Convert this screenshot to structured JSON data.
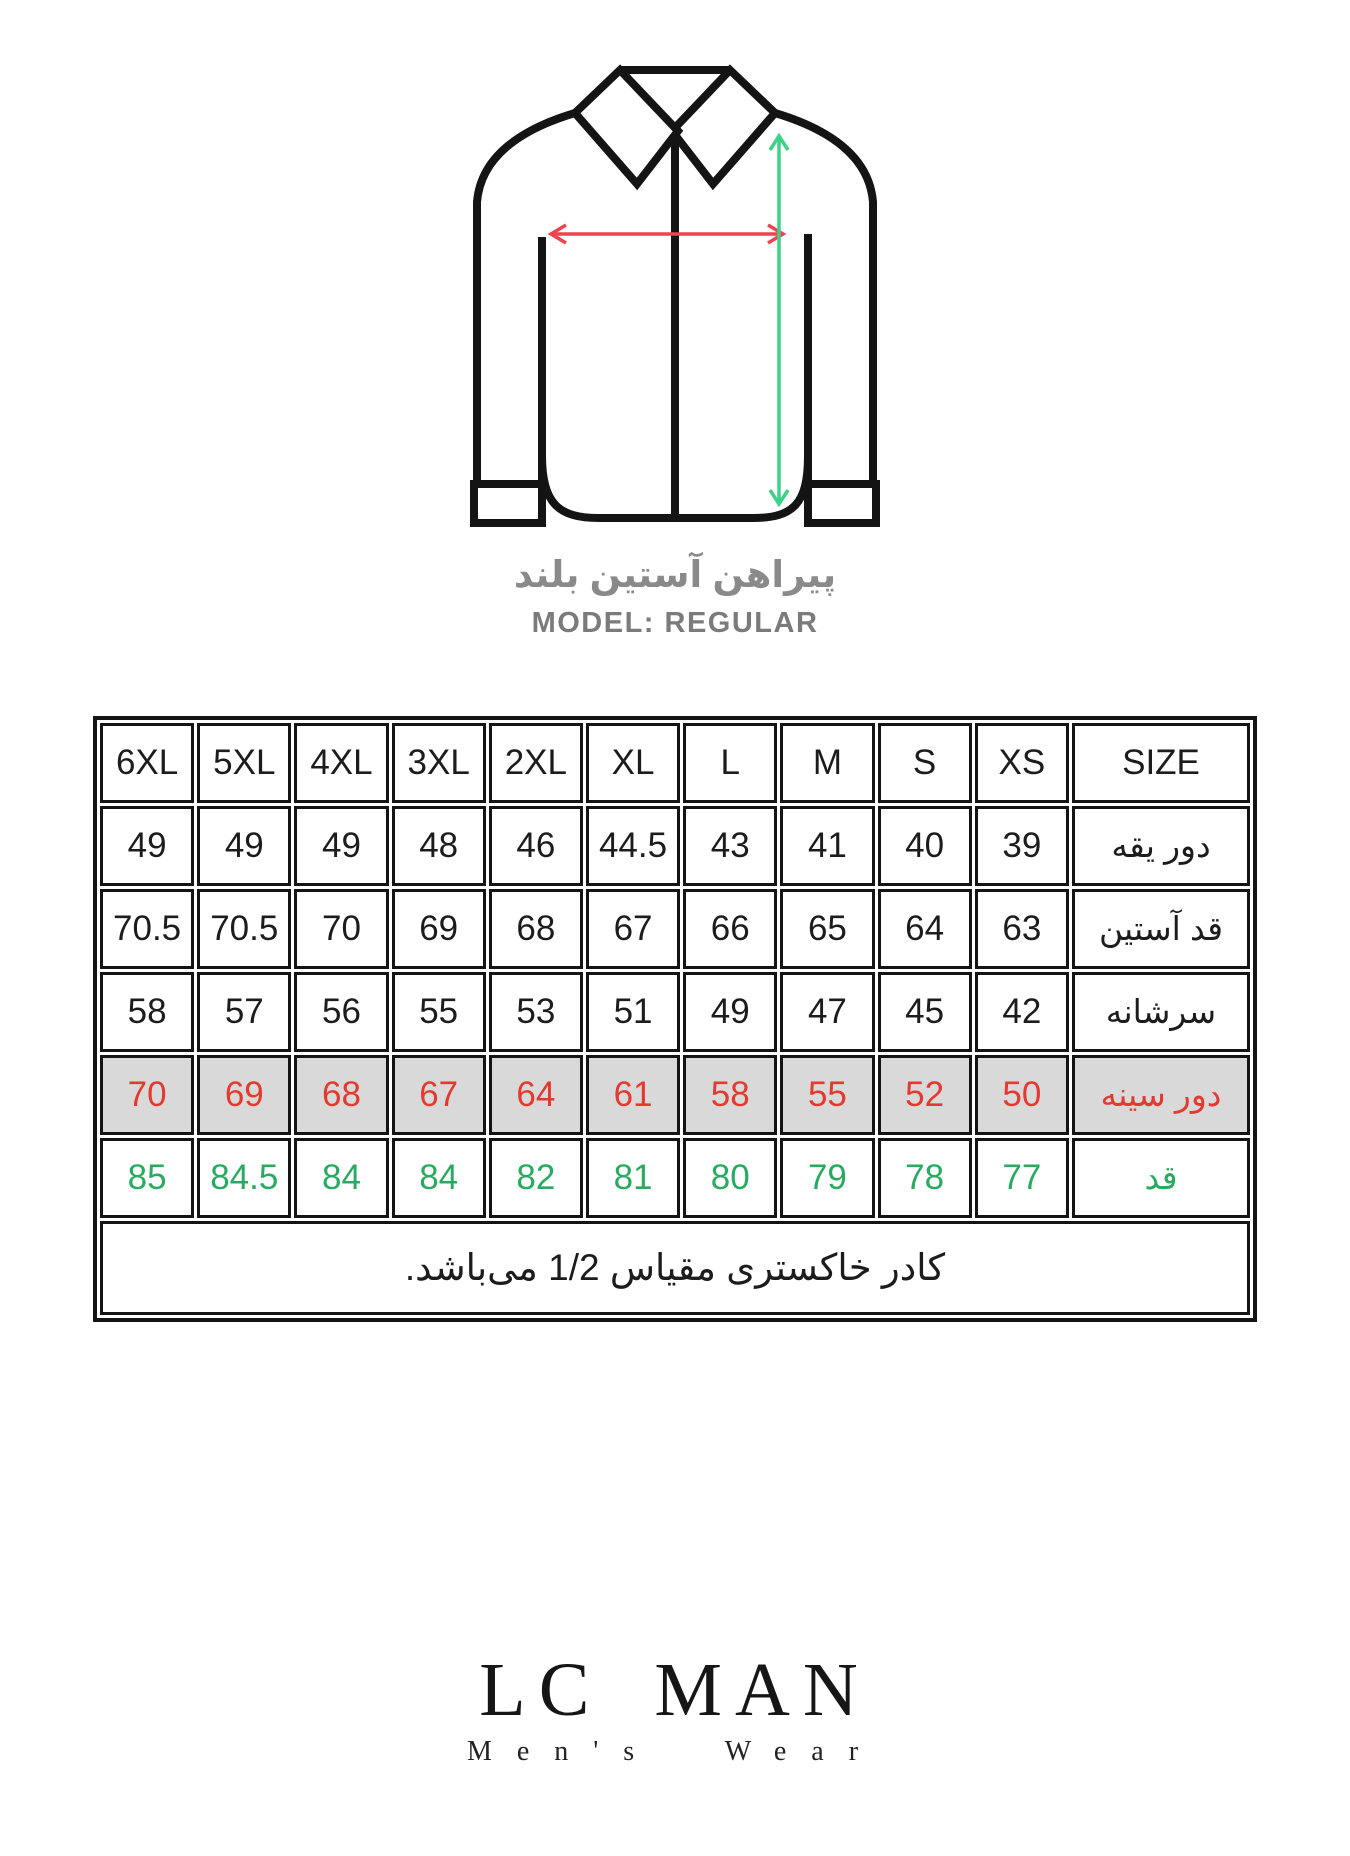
{
  "figure": {
    "title_fa": "پیراهن آستین بلند",
    "model": "MODEL: REGULAR"
  },
  "table": {
    "header": [
      "6XL",
      "5XL",
      "4XL",
      "3XL",
      "2XL",
      "XL",
      "L",
      "M",
      "S",
      "XS",
      "SIZE"
    ],
    "rows": [
      {
        "label": "دور یقه",
        "style": "normal",
        "values": [
          "49",
          "49",
          "49",
          "48",
          "46",
          "44.5",
          "43",
          "41",
          "40",
          "39"
        ]
      },
      {
        "label": "قد آستین",
        "style": "normal",
        "values": [
          "70.5",
          "70.5",
          "70",
          "69",
          "68",
          "67",
          "66",
          "65",
          "64",
          "63"
        ]
      },
      {
        "label": "سرشانه",
        "style": "normal",
        "values": [
          "58",
          "57",
          "56",
          "55",
          "53",
          "51",
          "49",
          "47",
          "45",
          "42"
        ]
      },
      {
        "label": "دور سینه",
        "style": "chest",
        "values": [
          "70",
          "69",
          "68",
          "67",
          "64",
          "61",
          "58",
          "55",
          "52",
          "50"
        ]
      },
      {
        "label": "قد",
        "style": "height",
        "values": [
          "85",
          "84.5",
          "84",
          "84",
          "82",
          "81",
          "80",
          "79",
          "78",
          "77"
        ]
      }
    ],
    "note": "کادر خاکستری مقیاس 1/2 می‌باشد."
  },
  "logo": {
    "name": "LC MAN",
    "subtitle": "Men's Wear"
  },
  "colors": {
    "chest_row_bg": "#d9d9d9",
    "chest_text": "#e4392f",
    "height_text": "#2aaa60",
    "chest_arrow": "#ee444d",
    "length_arrow": "#3dd18a",
    "title_gray": "#8a8a8a",
    "line_black": "#141414"
  }
}
